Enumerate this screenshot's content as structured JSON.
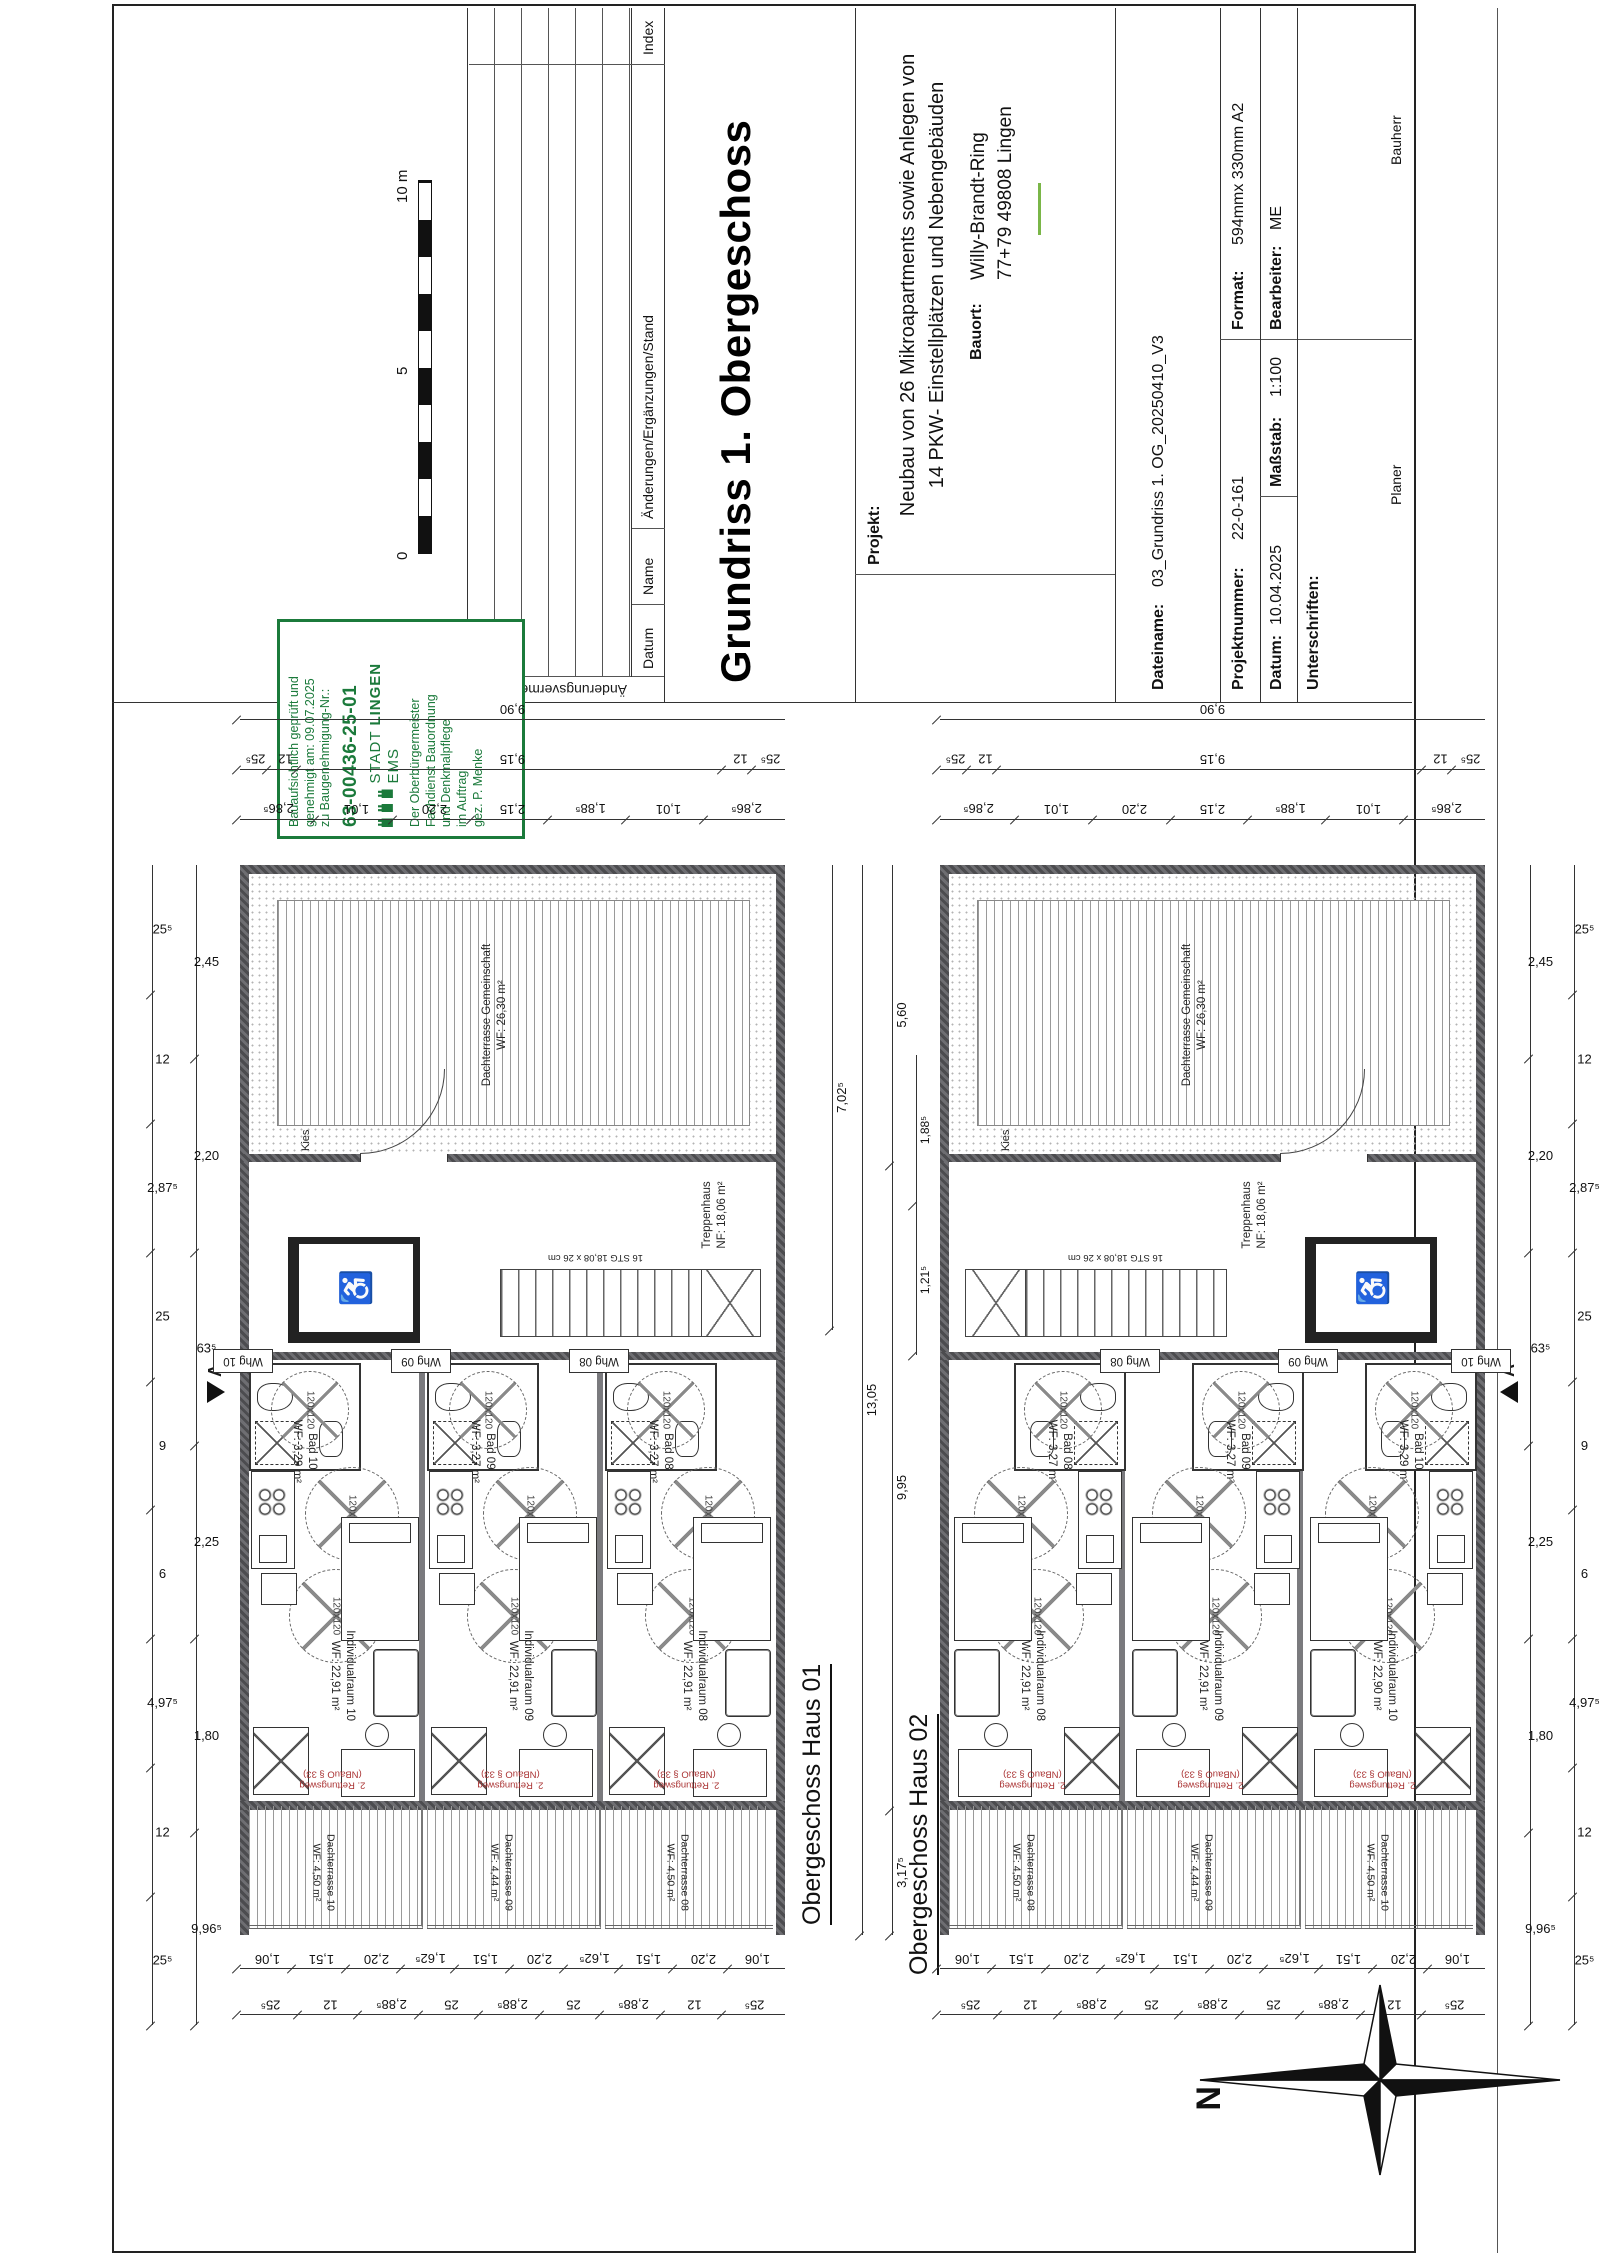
{
  "sheet": {
    "title": "Grundriss 1. Obergeschoss",
    "revision": {
      "side_label": "Änderungsvermerke",
      "col_datum": "Datum",
      "col_name": "Name",
      "col_aend": "Änderungen/Ergänzungen/Stand",
      "col_index": "Index"
    },
    "project": {
      "label": "Projekt:",
      "line1": "Neubau von 26 Mikroapartments sowie Anlegen von",
      "line2": "14 PKW- Einstellplätzen und Nebengebäuden",
      "bauort_label": "Bauort:",
      "address1": "Willy-Brandt-Ring",
      "address2": "77+79 49808 Lingen"
    },
    "meta": {
      "dateiname_label": "Dateiname:",
      "dateiname": "03_Grundriss 1. OG_20250410_V3",
      "projektnummer_label": "Projektnummer:",
      "projektnummer": "22-0-161",
      "format_label": "Format:",
      "format": "594mmx 330mm A2",
      "datum_label": "Datum:",
      "datum": "10.04.2025",
      "massstab_label": "Maßstab:",
      "massstab": "1:100",
      "bearbeiter_label": "Bearbeiter:",
      "bearbeiter": "ME",
      "unterschriften_label": "Unterschriften:",
      "planer_label": "Planer",
      "bauherr_label": "Bauherr"
    },
    "scalebar": {
      "zero": "0",
      "five": "5",
      "ten": "10 m"
    },
    "stamp": {
      "line1": "Bauaufsichtlich geprüft und",
      "line2": "genehmigt am: 09.07.2025",
      "line3": "zu Baugenehmigung-Nr.:",
      "number": "63-00436-25-01",
      "city_prefix": "STADT",
      "city": "LINGEN",
      "city_suffix": "EMS",
      "sub1": "Der Oberbürgermeister",
      "sub2": "Fachdienst Bauordnung",
      "sub3": "und Denkmalpflege",
      "sub4": "im Auftrag",
      "sub5": "gez. P. Menke",
      "green": "#1b7a3b"
    },
    "north_label": "N",
    "section_marker": "A"
  },
  "haus01": {
    "label": "Obergeschoss Haus 01",
    "terrace_name": "Dachterrasse Gemeinschaft",
    "terrace_area": "WF: 26,30 m²",
    "kies": "Kies",
    "stair_name": "Treppenhaus",
    "stair_area": "NF: 18,06 m²",
    "stair_steps": "16 STG 18,08 x 26 cm",
    "units": [
      {
        "whg": "Whg 10",
        "bad": "Bad 10",
        "bad_area": "WF: 3,29 m²",
        "room": "Individualraum 10",
        "room_area": "WF: 22,91 m²",
        "balcony": "Dachterrasse 10",
        "balcony_area": "WF: 4,50 m²"
      },
      {
        "whg": "Whg 09",
        "bad": "Bad 09",
        "bad_area": "WF: 3,27 m²",
        "room": "Individualraum 09",
        "room_area": "WF: 22,91 m²",
        "balcony": "Dachterrasse 09",
        "balcony_area": "WF: 4,44 m²"
      },
      {
        "whg": "Whg 08",
        "bad": "Bad 08",
        "bad_area": "WF: 3,27 m²",
        "room": "Individualraum 08",
        "room_area": "WF: 22,91 m²",
        "balcony": "Dachterrasse 08",
        "balcony_area": "WF: 4,50 m²"
      }
    ],
    "escape1": "2. Rettungsweg",
    "escape2": "(NBauO § 33)",
    "circle_label": "120x120"
  },
  "haus02": {
    "label": "Obergeschoss Haus 02",
    "terrace_name": "Dachterrasse Gemeinschaft",
    "terrace_area": "WF: 26,30 m²",
    "kies": "Kies",
    "stair_name": "Treppenhaus",
    "stair_area": "NF: 18,06 m²",
    "stair_steps": "16 STG 18,08 x 26 cm",
    "units": [
      {
        "whg": "Whg 08",
        "bad": "Bad 08",
        "bad_area": "WF: 3,27 m²",
        "room": "Individualraum 08",
        "room_area": "WF: 22,91 m²",
        "balcony": "Dachterrasse 08",
        "balcony_area": "WF: 4,50 m²"
      },
      {
        "whg": "Whg 09",
        "bad": "Bad 09",
        "bad_area": "WF: 3,27 m²",
        "room": "Individualraum 09",
        "room_area": "WF: 22,91 m²",
        "balcony": "Dachterrasse 09",
        "balcony_area": "WF: 4,44 m²"
      },
      {
        "whg": "Whg 10",
        "bad": "Bad 10",
        "bad_area": "WF: 3,29 m²",
        "room": "Individualraum 10",
        "room_area": "WF: 22,90 m²",
        "balcony": "Dachterrasse 10",
        "balcony_area": "WF: 4,50 m²"
      }
    ],
    "escape1": "2. Rettungsweg",
    "escape2": "(NBauO § 33)",
    "circle_label": "120x120"
  },
  "dims": {
    "v_inner": [
      "2,86⁵",
      "1,01",
      "2,20",
      "2,15",
      "1,88⁵",
      "1,01",
      "2,86⁵"
    ],
    "v_mid": [
      "25⁵",
      "12",
      "9,15",
      "12",
      "25⁵"
    ],
    "v_outer": [
      "9,90"
    ],
    "h_outer": [
      "25⁵",
      "12",
      "4,97⁵",
      "6",
      "9",
      "25",
      "2,87⁵",
      "12",
      "25⁵"
    ],
    "h_inner": [
      "9,96⁵",
      "1,80",
      "2,25",
      "63⁵",
      "2,20",
      "2,45"
    ],
    "l_outer": [
      "25⁵",
      "12",
      "2,88⁵",
      "25",
      "2,88⁵",
      "25",
      "2,88⁵",
      "12",
      "25⁵"
    ],
    "l_inner": [
      "1,06",
      "1,51",
      "2,20",
      "1,62⁵",
      "1,51",
      "2,20",
      "1,62⁵",
      "1,51",
      "2,20",
      "1,06"
    ],
    "gap_702": "7,02⁵",
    "gap_1305": "13,05",
    "gap_995": "9,95",
    "gap_3175": "3,17⁵",
    "gap_560": "5,60",
    "gap_1885": "1,88⁵",
    "gap_1215": "1,21⁵"
  }
}
